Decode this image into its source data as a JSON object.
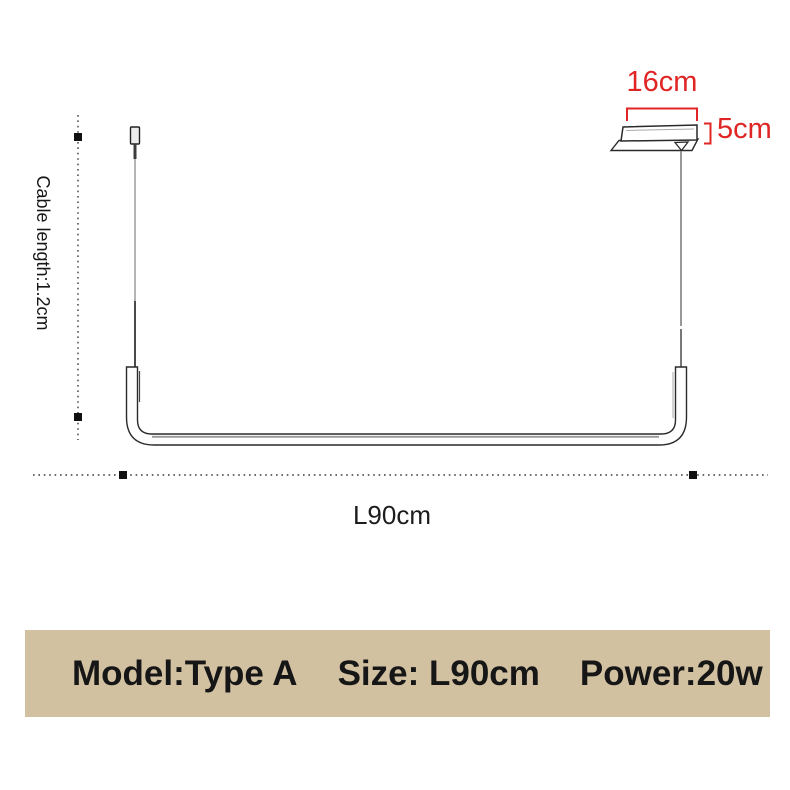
{
  "diagram": {
    "canopy_width_label": "16cm",
    "canopy_height_label": "5cm",
    "cable_length_label": "Cable length:1.2cm",
    "lamp_length_label": "L90cm"
  },
  "spec_banner": {
    "model": "Model:Type A",
    "size": "Size: L90cm",
    "power": "Power:20w"
  },
  "colors": {
    "dimension_accent": "#e02525",
    "banner_background": "#d1c1a1",
    "banner_text": "#161616",
    "line": "#2a2a2a"
  }
}
